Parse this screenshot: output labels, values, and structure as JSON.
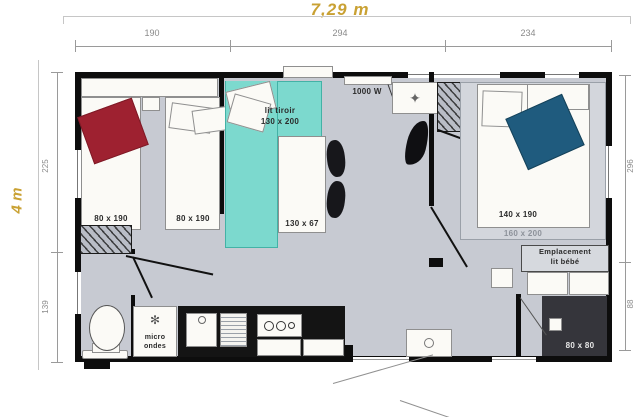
{
  "plan": {
    "overall_width_label": "7,29 m",
    "overall_depth_label": "4 m"
  },
  "dimensions": {
    "top_segments": [
      "190",
      "294",
      "234"
    ],
    "left_segments": [
      "225",
      "139"
    ],
    "right_segments": [
      "296",
      "88"
    ]
  },
  "labels": {
    "bed_single_left": "80 x 190",
    "bed_single_right": "80 x 190",
    "sofa_bed_name": "lit tiroir",
    "sofa_bed_size": "130 x 200",
    "table_size": "130 x 67",
    "heater_power": "1000 W",
    "double_bed_size": "140 x 190",
    "platform_size": "160 x 200",
    "baby_area_line1": "Emplacement",
    "baby_area_line2": "lit bébé",
    "microwave_line1": "micro",
    "microwave_line2": "ondes",
    "shower_size": "80 x 80"
  },
  "icons": {
    "vent_star": "✦",
    "microwave_fan": "✻"
  },
  "colors": {
    "accent_yellow": "#c9a133",
    "floor_gray": "#c7cad2",
    "sofa_teal": "#7cd9ce",
    "pillow_red": "#9e2130",
    "blanket_blue": "#1f5b7e",
    "wall_black": "#0d0d0d"
  }
}
